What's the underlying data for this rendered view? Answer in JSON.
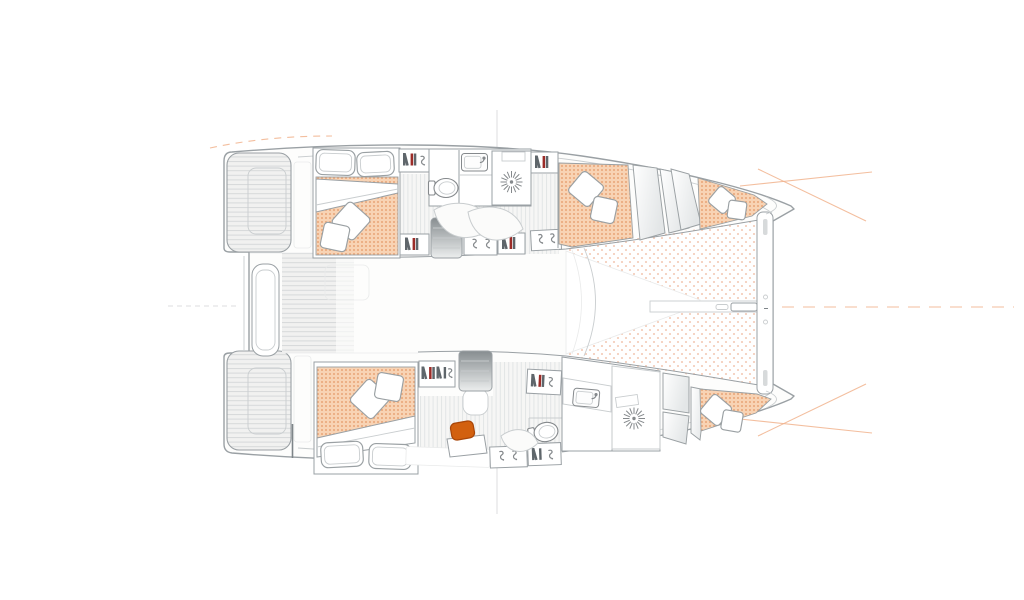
{
  "meta": {
    "title": "Catamaran interior deck plan (top-down floor plan, bow to the right)",
    "view": "top-down",
    "visible_text": "none"
  },
  "colors": {
    "background": "#ffffff",
    "deck_fill": "#fdfdfc",
    "hull_stroke": "#9aa0a4",
    "hull_stroke_dark": "#7e8589",
    "furniture_stroke": "#9aa0a3",
    "light_stroke": "#c9cdcf",
    "faint_stroke": "#e9eaea",
    "floor_base": "#f6f6f5",
    "floor_stripe": "#e2e5e6",
    "deck_base": "#f1f1f0",
    "deck_stripe": "#d6d9da",
    "mattress_base": "#f8d3b4",
    "mattress_dot": "#e8a173",
    "trampoline_dot": "#f3c9b4",
    "steps_dark": "#878d90",
    "steps_light": "#eceeee",
    "panel_shade": "#e3e6e7",
    "accent_orange": "#d2600f",
    "accent_orange_dark": "#a84508",
    "book_red": "#9c2c28",
    "book_dark": "#5f666b",
    "icon_gray": "#85898c",
    "guide_orange": "#f1b38d",
    "guide_gray": "#dcdedf"
  },
  "labels": {
    "boat": "catamaran-deck-plan",
    "hull_top": "starboard-hull-interior",
    "hull_bottom": "port-hull-interior",
    "cockpit": "aft-cockpit-and-swim-platforms",
    "foredeck": "trampoline-and-forward-crossbeam"
  },
  "inventory": {
    "exterior": {
      "swim_platforms": 2,
      "deck_finish": "planked",
      "cockpit_bench": 1,
      "trampoline": 1,
      "forward_crossbeam": 1,
      "bow_centerline_fitting": 1
    },
    "hull_top": {
      "aft_cabin": {
        "berth": "double",
        "pillows": 2,
        "cushions": 2,
        "duvet": 1
      },
      "bathroom": [
        "sink",
        "toilet",
        "shower-drain"
      ],
      "companionway_steps": 1,
      "bookshelves": 4,
      "hanging_lockers": 2,
      "forward_cabin": {
        "berth": "double",
        "cushions": 2,
        "wardrobe_panels": 2
      },
      "forepeak_berth": {
        "cushions": 2
      }
    },
    "hull_bottom": {
      "aft_cabin": {
        "berth": "double",
        "pillows": 2,
        "cushions": 2,
        "duvet": 1
      },
      "nav_desk": {
        "stool": "orange"
      },
      "bathroom": [
        "sink",
        "toilet",
        "shower-drain"
      ],
      "companionway_steps": 1,
      "bookshelves": 4,
      "hanging_lockers": 2,
      "forward_cabin": {
        "berth": "double",
        "cushions": 2,
        "wardrobe_panels": 3
      }
    },
    "berths_total": 5
  }
}
